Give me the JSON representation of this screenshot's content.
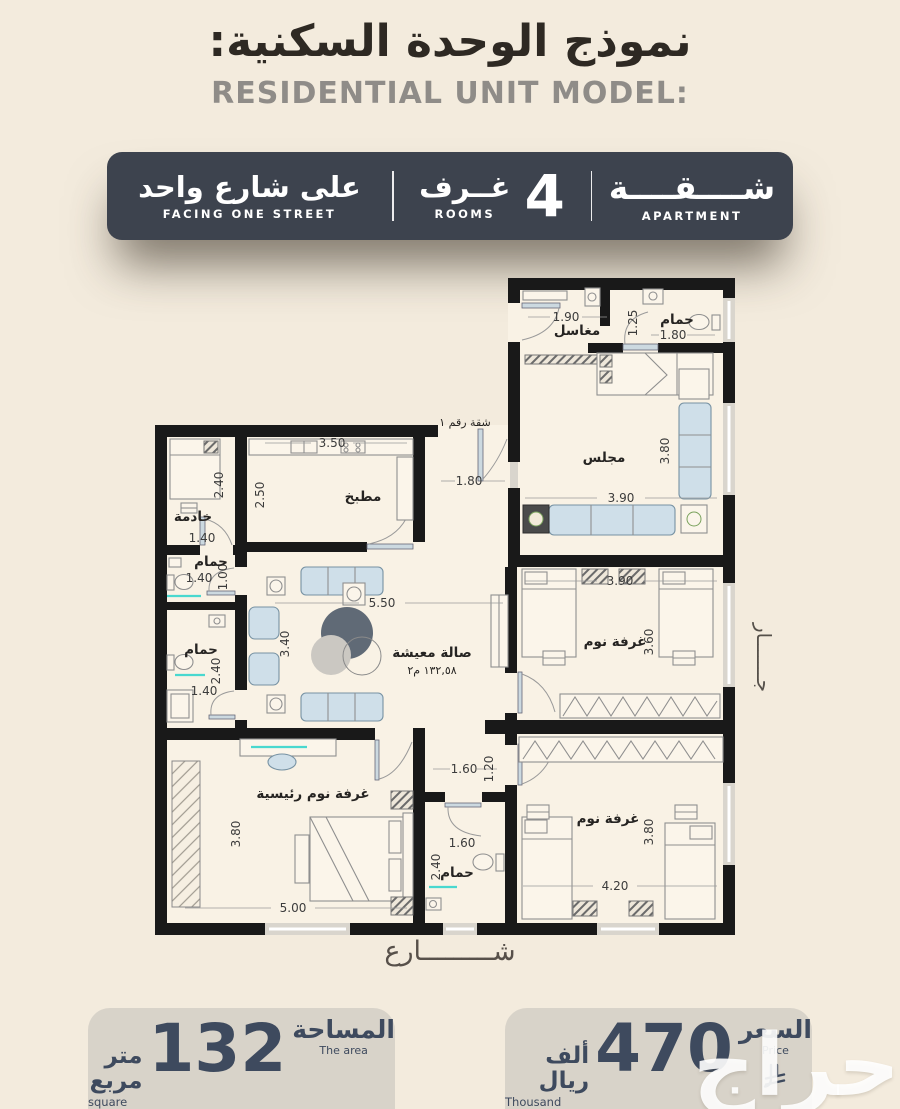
{
  "header": {
    "title_ar": "نموذج الوحدة السكنية:",
    "title_en": "RESIDENTIAL UNIT MODEL:"
  },
  "banner": {
    "street": {
      "ar": "على شارع واحد",
      "en": "FACING ONE STREET"
    },
    "rooms": {
      "count": "4",
      "ar": "غــرف",
      "en": "ROOMS"
    },
    "apartment": {
      "ar": "شــــقــــة",
      "en": "APARTMENT"
    }
  },
  "plan": {
    "apartment_no": "شقة رقم ١",
    "street_label": "شـــــــــارع",
    "neighbor_label": "جـــــــار",
    "rooms": {
      "washbasins": "مغاسل",
      "bath_top": "حمام",
      "majlis": "مجلس",
      "maid_room": "خادمة",
      "maid_bath": "حمام",
      "kitchen": "مطبخ",
      "living": "صالة معيشة",
      "living_area": "١٣٢,٥٨ م٢",
      "guest_bath": "حمام",
      "bedroom_mid": "غرفة نوم",
      "master_bedroom": "غرفة نوم رئيسية",
      "bath_mid": "حمام",
      "bedroom_bottom": "غرفة نوم"
    },
    "dims": [
      "1.90",
      "1.25",
      "1.80",
      "3.80",
      "3.90",
      "2.40",
      "1.40",
      "1.40",
      "1.00",
      "3.50",
      "2.50",
      "1.80",
      "5.50",
      "3.40",
      "2.40",
      "1.40",
      "3.90",
      "3.60",
      "1.60",
      "1.20",
      "1.60",
      "2.40",
      "3.80",
      "5.00",
      "4.20",
      "3.80"
    ]
  },
  "area_badge": {
    "title_ar": "المساحة",
    "title_en": "The area",
    "value": "132",
    "unit_ar": "متر مربع",
    "unit_en": "square meter"
  },
  "price_badge": {
    "title_ar": "السعر",
    "title_en": "Price",
    "value": "470",
    "unit_ar": "ألف ريال",
    "unit_en": "Thousand Riyals"
  },
  "watermark": "حراج",
  "colors": {
    "banner_bg": "#3d434e",
    "badge_bg": "#d8d3c9",
    "accent_text": "#3e4a5e",
    "page_bg": "#f3ebdd"
  }
}
